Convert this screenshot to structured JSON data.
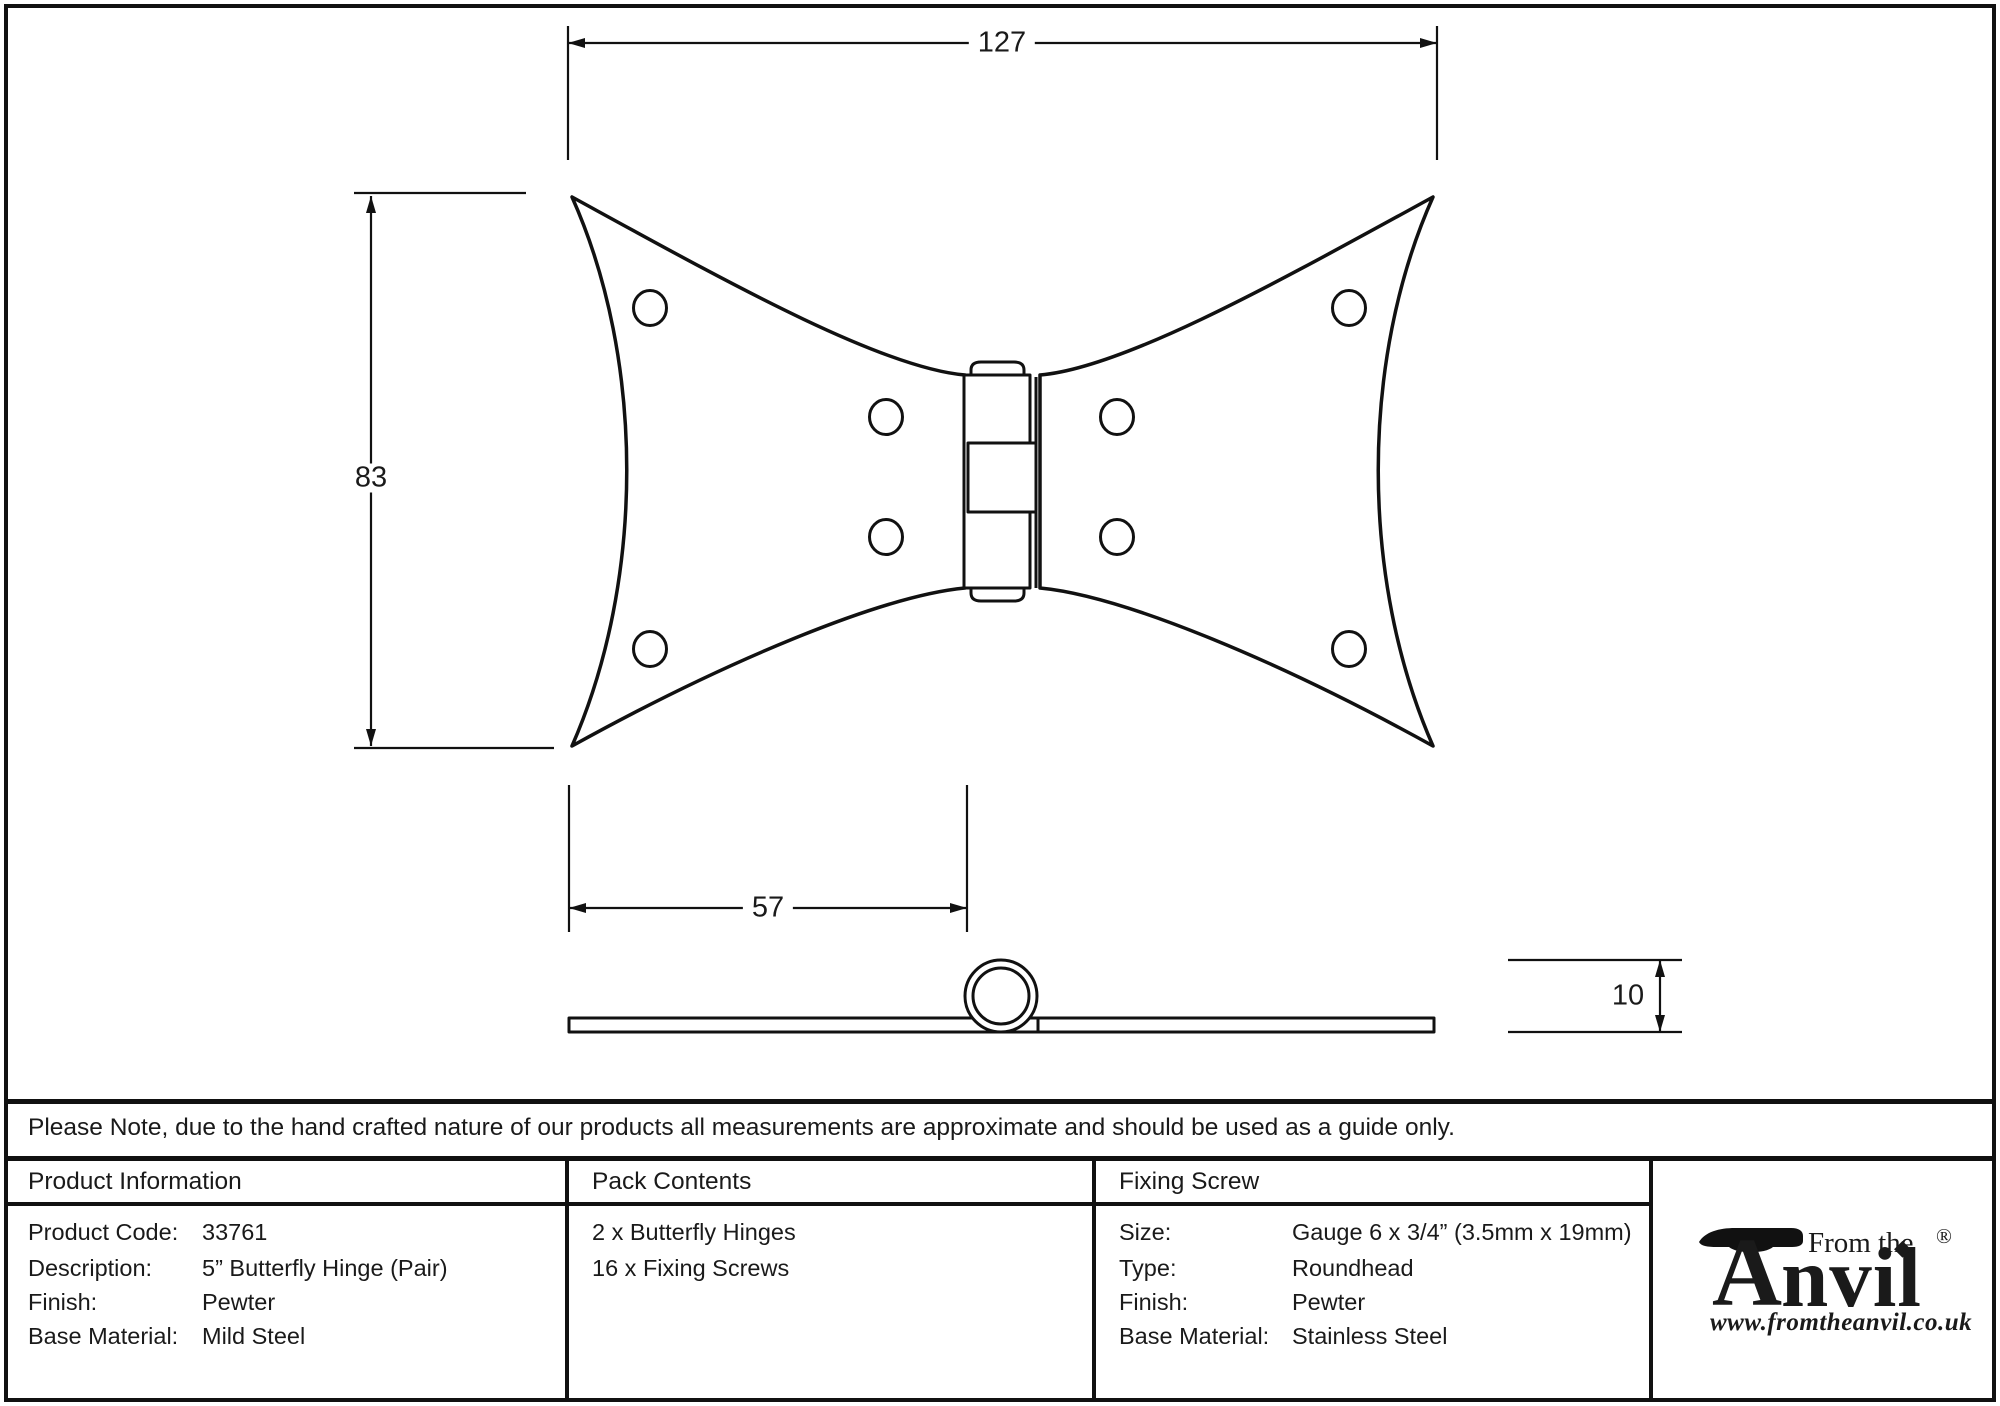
{
  "drawing": {
    "dimensions": {
      "width_mm": "127",
      "height_mm": "83",
      "leaf_width_mm": "57",
      "knuckle_mm": "10"
    }
  },
  "note": "Please Note, due to the hand crafted nature of our products all measurements are approximate and should be used as a guide only.",
  "product_information": {
    "header": "Product Information",
    "rows": [
      {
        "label": "Product Code:",
        "value": "33761"
      },
      {
        "label": "Description:",
        "value": "5” Butterfly Hinge (Pair)"
      },
      {
        "label": "Finish:",
        "value": "Pewter"
      },
      {
        "label": "Base Material:",
        "value": "Mild Steel"
      }
    ]
  },
  "pack_contents": {
    "header": "Pack Contents",
    "items": [
      "2 x Butterfly Hinges",
      "16 x Fixing Screws"
    ]
  },
  "fixing_screw": {
    "header": "Fixing Screw",
    "rows": [
      {
        "label": "Size:",
        "value": "Gauge 6 x 3/4” (3.5mm x 19mm)"
      },
      {
        "label": "Type:",
        "value": "Roundhead"
      },
      {
        "label": "Finish:",
        "value": "Pewter"
      },
      {
        "label": "Base Material:",
        "value": "Stainless Steel"
      }
    ]
  },
  "logo": {
    "from_the": "From the",
    "anvil_initial": "A",
    "anvil_rest": "nvil",
    "diamond": "◆",
    "registered": "®",
    "website": "www.fromtheanvil.co.uk"
  },
  "colors": {
    "ink": "#1a1a1a",
    "paper": "#ffffff"
  }
}
